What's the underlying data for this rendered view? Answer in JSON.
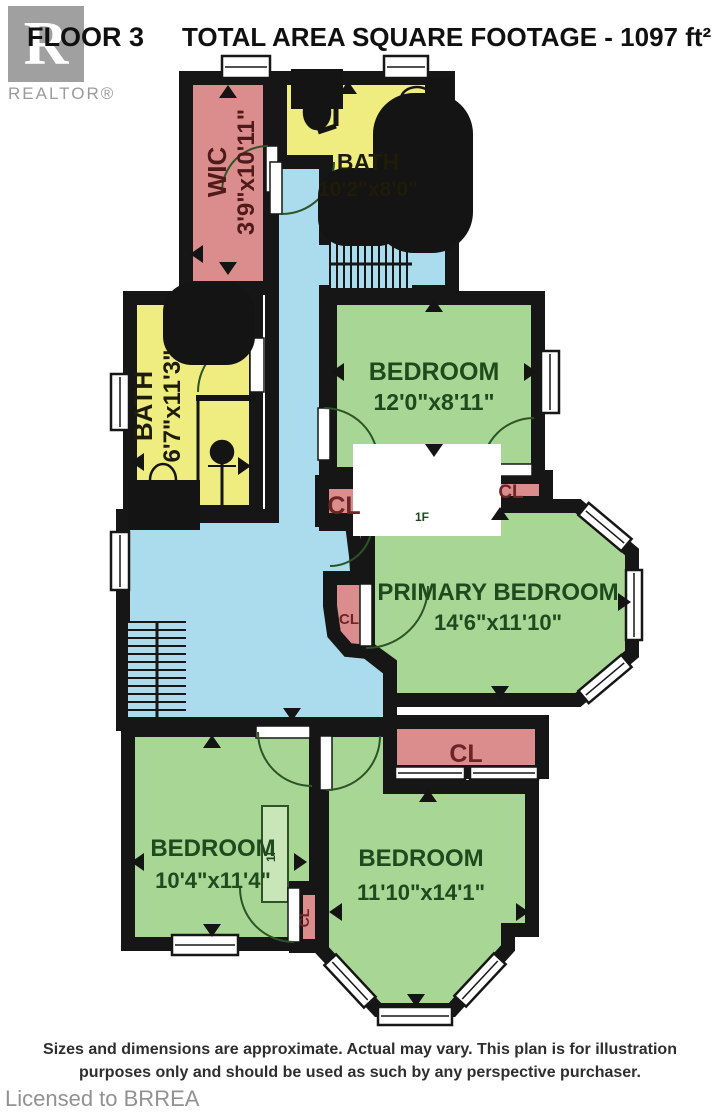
{
  "header": {
    "floor_label": "FLOOR 3",
    "title": "TOTAL AREA SQUARE FOOTAGE - 1097 ft²"
  },
  "logo": {
    "letter": "R",
    "brand": "REALTOR®"
  },
  "footer": {
    "line1": "Sizes and dimensions are approximate. Actual may vary. This plan is for illustration",
    "line2": "purposes only and should be used as such by any perspective purchaser."
  },
  "watermark": "Licensed to BRREA",
  "plan": {
    "colors": {
      "wall": "#161616",
      "pink": "#db8c8c",
      "yellow": "#efec80",
      "green": "#a8d795",
      "blue": "#abdcee",
      "white": "#ffffff",
      "greenText": "#1e4a1e",
      "yellowText": "#1c1c08",
      "pinkText": "#4f1a1a",
      "clText": "#6b2525"
    },
    "rooms": [
      {
        "id": "hallway",
        "fill": "blue",
        "points": [
          [
            272,
            162
          ],
          [
            326,
            162
          ],
          [
            326,
            238
          ],
          [
            452,
            238
          ],
          [
            452,
            292
          ],
          [
            326,
            292
          ],
          [
            326,
            524
          ],
          [
            352,
            524
          ],
          [
            356,
            556
          ],
          [
            362,
            648
          ],
          [
            390,
            670
          ],
          [
            390,
            724
          ],
          [
            123,
            724
          ],
          [
            123,
            516
          ],
          [
            272,
            516
          ]
        ]
      },
      {
        "id": "wic",
        "fill": "pink",
        "rect": [
          186,
          78,
          84,
          210
        ]
      },
      {
        "id": "bath-top",
        "fill": "yellow",
        "points": [
          [
            280,
            78
          ],
          [
            448,
            78
          ],
          [
            448,
            230
          ],
          [
            326,
            230
          ],
          [
            326,
            162
          ],
          [
            280,
            162
          ]
        ]
      },
      {
        "id": "bath-left",
        "fill": "yellow",
        "rect": [
          130,
          298,
          126,
          214
        ]
      },
      {
        "id": "bedroom-top",
        "fill": "green",
        "rect": [
          330,
          298,
          208,
          176
        ]
      },
      {
        "id": "primary-bedroom",
        "fill": "green",
        "points": [
          [
            368,
            506
          ],
          [
            578,
            506
          ],
          [
            632,
            552
          ],
          [
            632,
            654
          ],
          [
            578,
            700
          ],
          [
            390,
            700
          ],
          [
            390,
            664
          ],
          [
            368,
            648
          ]
        ]
      },
      {
        "id": "bedroom-bottom-left",
        "fill": "green",
        "rect": [
          128,
          730,
          188,
          214
        ]
      },
      {
        "id": "bedroom-bottom",
        "fill": "green",
        "points": [
          [
            322,
            730
          ],
          [
            390,
            730
          ],
          [
            390,
            787
          ],
          [
            532,
            787
          ],
          [
            532,
            930
          ],
          [
            508,
            930
          ],
          [
            508,
            948
          ],
          [
            452,
            1010
          ],
          [
            378,
            1010
          ],
          [
            322,
            950
          ]
        ]
      },
      {
        "id": "closet-left",
        "fill": "pink",
        "rect": [
          322,
          482,
          46,
          38
        ]
      },
      {
        "id": "closet-right",
        "fill": "pink",
        "rect": [
          478,
          477,
          68,
          26
        ]
      },
      {
        "id": "closet-bottom",
        "fill": "pink",
        "rect": [
          390,
          722,
          152,
          50
        ]
      },
      {
        "id": "closet-curved",
        "fill": "pink",
        "points": [
          [
            330,
            578
          ],
          [
            368,
            578
          ],
          [
            368,
            652
          ],
          [
            348,
            650
          ],
          [
            334,
            634
          ],
          [
            330,
            606
          ]
        ]
      },
      {
        "id": "closet-small",
        "fill": "pink",
        "rect": [
          296,
          888,
          26,
          58
        ]
      },
      {
        "id": "chimney",
        "fill": "wall",
        "rect": [
          383,
          476,
          88,
          28
        ],
        "sw": 4
      }
    ],
    "boxes": [
      {
        "id": "flue-box-1",
        "rect": [
          392,
          506,
          60,
          22
        ]
      },
      {
        "id": "flue-box-2",
        "rect": [
          262,
          806,
          26,
          96
        ]
      }
    ],
    "stairs": [
      {
        "x": 330,
        "y": 240,
        "w": 82,
        "h": 48,
        "dir": "v",
        "step": 7
      },
      {
        "x": 128,
        "y": 622,
        "w": 58,
        "h": 96,
        "dir": "h",
        "step": 8
      }
    ],
    "windows": [
      {
        "cx": 246,
        "cy": 67,
        "w": 48,
        "h": 22,
        "rot": 0
      },
      {
        "cx": 406,
        "cy": 67,
        "w": 44,
        "h": 22,
        "rot": 0
      },
      {
        "cx": 550,
        "cy": 382,
        "w": 18,
        "h": 62,
        "rot": 0
      },
      {
        "cx": 120,
        "cy": 402,
        "w": 18,
        "h": 56,
        "rot": 0
      },
      {
        "cx": 120,
        "cy": 561,
        "w": 18,
        "h": 58,
        "rot": 0
      },
      {
        "cx": 205,
        "cy": 945,
        "w": 66,
        "h": 20,
        "rot": 0
      },
      {
        "cx": 605,
        "cy": 527,
        "w": 56,
        "h": 16,
        "rot": 40
      },
      {
        "cx": 634,
        "cy": 605,
        "w": 16,
        "h": 70,
        "rot": 0
      },
      {
        "cx": 605,
        "cy": 679,
        "w": 56,
        "h": 16,
        "rot": -40
      },
      {
        "cx": 350,
        "cy": 981,
        "w": 58,
        "h": 16,
        "rot": 47
      },
      {
        "cx": 415,
        "cy": 1016,
        "w": 74,
        "h": 18,
        "rot": 0
      },
      {
        "cx": 480,
        "cy": 980,
        "w": 58,
        "h": 16,
        "rot": -47
      },
      {
        "cx": 430,
        "cy": 773,
        "w": 70,
        "h": 13,
        "rot": 0
      },
      {
        "cx": 504,
        "cy": 773,
        "w": 68,
        "h": 13,
        "rot": 0
      }
    ],
    "door_leaves": [
      [
        266,
        146,
        12,
        46
      ],
      [
        270,
        162,
        12,
        52
      ],
      [
        250,
        338,
        14,
        54
      ],
      [
        318,
        408,
        12,
        52
      ],
      [
        480,
        464,
        52,
        12
      ],
      [
        360,
        584,
        12,
        62
      ],
      [
        256,
        726,
        54,
        12
      ],
      [
        288,
        888,
        12,
        54
      ],
      [
        320,
        736,
        12,
        54
      ]
    ],
    "door_arcs": [
      "M268,146 A46,46 0 0 0 222,192",
      "M334,162 A52,52 0 0 1 282,214",
      "M252,338 A54,54 0 0 0 198,392",
      "M324,408 A54,54 0 0 1 378,462",
      "M482,470 A52,52 0 0 1 534,418",
      "M366,648 A62,62 0 0 0 428,586",
      "M258,732 A54,54 0 0 0 312,786",
      "M294,942 A54,54 0 0 1 240,888",
      "M326,790 A54,54 0 0 0 380,736",
      "M330,566 A42,42 0 0 0 372,524"
    ],
    "fixtures": [
      {
        "t": "rect",
        "x": 304,
        "y": 82,
        "w": 26,
        "h": 14,
        "f": "#141414"
      },
      {
        "t": "ellipse",
        "cx": 317,
        "cy": 112,
        "rx": 13,
        "ry": 17,
        "f": "#141414"
      },
      {
        "t": "line",
        "x1": 336,
        "y1": 78,
        "x2": 336,
        "y2": 126,
        "w": 5
      },
      {
        "t": "line",
        "x1": 318,
        "y1": 132,
        "x2": 336,
        "y2": 126,
        "w": 5
      },
      {
        "t": "rect",
        "x": 432,
        "y": 84,
        "w": 14,
        "h": 30
      },
      {
        "t": "ellipse",
        "cx": 417,
        "cy": 99,
        "rx": 16,
        "ry": 12
      },
      {
        "t": "rect",
        "x": 398,
        "y": 118,
        "w": 50,
        "h": 110,
        "rx": 16
      },
      {
        "t": "rect",
        "x": 405,
        "y": 125,
        "w": 36,
        "h": 96,
        "rx": 14
      },
      {
        "t": "circle",
        "cx": 423,
        "cy": 206,
        "r": 2.5,
        "f": "#141414"
      },
      {
        "t": "rect",
        "x": 340,
        "y": 190,
        "w": 44,
        "h": 34,
        "rx": 6
      },
      {
        "t": "rect",
        "x": 346,
        "y": 196,
        "w": 32,
        "h": 22,
        "rx": 4
      },
      {
        "t": "circle",
        "cx": 362,
        "cy": 214,
        "r": 2,
        "f": "#141414"
      },
      {
        "t": "rect",
        "x": 186,
        "y": 306,
        "w": 46,
        "h": 36,
        "rx": 6
      },
      {
        "t": "rect",
        "x": 192,
        "y": 312,
        "w": 34,
        "h": 24,
        "rx": 4
      },
      {
        "t": "circle",
        "cx": 209,
        "cy": 330,
        "r": 2,
        "f": "#141414"
      },
      {
        "t": "line",
        "x1": 196,
        "y1": 398,
        "x2": 256,
        "y2": 398,
        "w": 6
      },
      {
        "t": "line",
        "x1": 198,
        "y1": 398,
        "x2": 198,
        "y2": 508,
        "w": 3
      },
      {
        "t": "rect",
        "x": 146,
        "y": 498,
        "w": 36,
        "h": 14
      },
      {
        "t": "ellipse",
        "cx": 163,
        "cy": 480,
        "rx": 13,
        "ry": 16
      },
      {
        "t": "line",
        "x1": 222,
        "y1": 505,
        "x2": 222,
        "y2": 462,
        "w": 3
      },
      {
        "t": "circle",
        "cx": 222,
        "cy": 452,
        "r": 11,
        "f": "#141414"
      },
      {
        "t": "line",
        "x1": 208,
        "y1": 466,
        "x2": 236,
        "y2": 466,
        "w": 2
      },
      {
        "t": "rect",
        "x": 390,
        "y": 481,
        "w": 74,
        "h": 18,
        "s": "#ffffff",
        "f": "none"
      }
    ],
    "arrows": [
      {
        "x": 228,
        "y": 92,
        "d": "up"
      },
      {
        "x": 228,
        "y": 268,
        "d": "down"
      },
      {
        "x": 197,
        "y": 254,
        "d": "left"
      },
      {
        "x": 348,
        "y": 88,
        "d": "up"
      },
      {
        "x": 440,
        "y": 164,
        "d": "right"
      },
      {
        "x": 408,
        "y": 224,
        "d": "down"
      },
      {
        "x": 182,
        "y": 306,
        "d": "up"
      },
      {
        "x": 138,
        "y": 462,
        "d": "left"
      },
      {
        "x": 244,
        "y": 466,
        "d": "right"
      },
      {
        "x": 182,
        "y": 504,
        "d": "down"
      },
      {
        "x": 434,
        "y": 306,
        "d": "up"
      },
      {
        "x": 338,
        "y": 372,
        "d": "left"
      },
      {
        "x": 530,
        "y": 372,
        "d": "right"
      },
      {
        "x": 434,
        "y": 450,
        "d": "down"
      },
      {
        "x": 500,
        "y": 514,
        "d": "up"
      },
      {
        "x": 624,
        "y": 602,
        "d": "right"
      },
      {
        "x": 500,
        "y": 692,
        "d": "down"
      },
      {
        "x": 212,
        "y": 742,
        "d": "up"
      },
      {
        "x": 138,
        "y": 862,
        "d": "left"
      },
      {
        "x": 300,
        "y": 862,
        "d": "right"
      },
      {
        "x": 212,
        "y": 930,
        "d": "down"
      },
      {
        "x": 428,
        "y": 796,
        "d": "up"
      },
      {
        "x": 336,
        "y": 912,
        "d": "left"
      },
      {
        "x": 522,
        "y": 912,
        "d": "right"
      },
      {
        "x": 416,
        "y": 1000,
        "d": "down"
      },
      {
        "x": 292,
        "y": 714,
        "d": "down"
      }
    ],
    "labels": [
      {
        "x": 226,
        "y": 172,
        "t": "WIC",
        "s": 26,
        "c": "pinkText",
        "rot": -90
      },
      {
        "x": 254,
        "y": 172,
        "t": "3'9\"x10'11\"",
        "s": 24,
        "c": "pinkText",
        "rot": -90
      },
      {
        "x": 368,
        "y": 170,
        "t": "BATH",
        "s": 23,
        "c": "yellowText"
      },
      {
        "x": 368,
        "y": 196,
        "t": "10'2\"x8'0\"",
        "s": 21,
        "c": "yellowText"
      },
      {
        "x": 152,
        "y": 406,
        "t": "BATH",
        "s": 26,
        "c": "yellowText",
        "rot": -90
      },
      {
        "x": 180,
        "y": 406,
        "t": "6'7\"x11'3\"",
        "s": 24,
        "c": "yellowText",
        "rot": -90
      },
      {
        "x": 434,
        "y": 380,
        "t": "BEDROOM",
        "s": 25,
        "c": "greenText"
      },
      {
        "x": 434,
        "y": 410,
        "t": "12'0\"x8'11\"",
        "s": 23,
        "c": "greenText"
      },
      {
        "x": 498,
        "y": 600,
        "t": "PRIMARY BEDROOM",
        "s": 24,
        "c": "greenText"
      },
      {
        "x": 498,
        "y": 630,
        "t": "14'6\"x11'10\"",
        "s": 22,
        "c": "greenText"
      },
      {
        "x": 213,
        "y": 856,
        "t": "BEDROOM",
        "s": 24,
        "c": "greenText"
      },
      {
        "x": 213,
        "y": 888,
        "t": "10'4\"x11'4\"",
        "s": 22,
        "c": "greenText"
      },
      {
        "x": 421,
        "y": 866,
        "t": "BEDROOM",
        "s": 24,
        "c": "greenText"
      },
      {
        "x": 421,
        "y": 900,
        "t": "11'10\"x14'1\"",
        "s": 22,
        "c": "greenText"
      },
      {
        "x": 344,
        "y": 514,
        "t": "CL",
        "s": 25,
        "c": "clText"
      },
      {
        "x": 511,
        "y": 498,
        "t": "CL",
        "s": 19,
        "c": "clText"
      },
      {
        "x": 466,
        "y": 762,
        "t": "CL",
        "s": 25,
        "c": "clText"
      },
      {
        "x": 349,
        "y": 624,
        "t": "CL",
        "s": 15,
        "c": "clText"
      },
      {
        "x": 309,
        "y": 918,
        "t": "CL",
        "s": 14,
        "c": "clText",
        "rot": -90
      },
      {
        "x": 422,
        "y": 521,
        "t": "1F",
        "s": 12,
        "c": "greenText"
      },
      {
        "x": 275,
        "y": 855,
        "t": "1F",
        "s": 12,
        "c": "greenText",
        "rot": -90
      }
    ]
  }
}
